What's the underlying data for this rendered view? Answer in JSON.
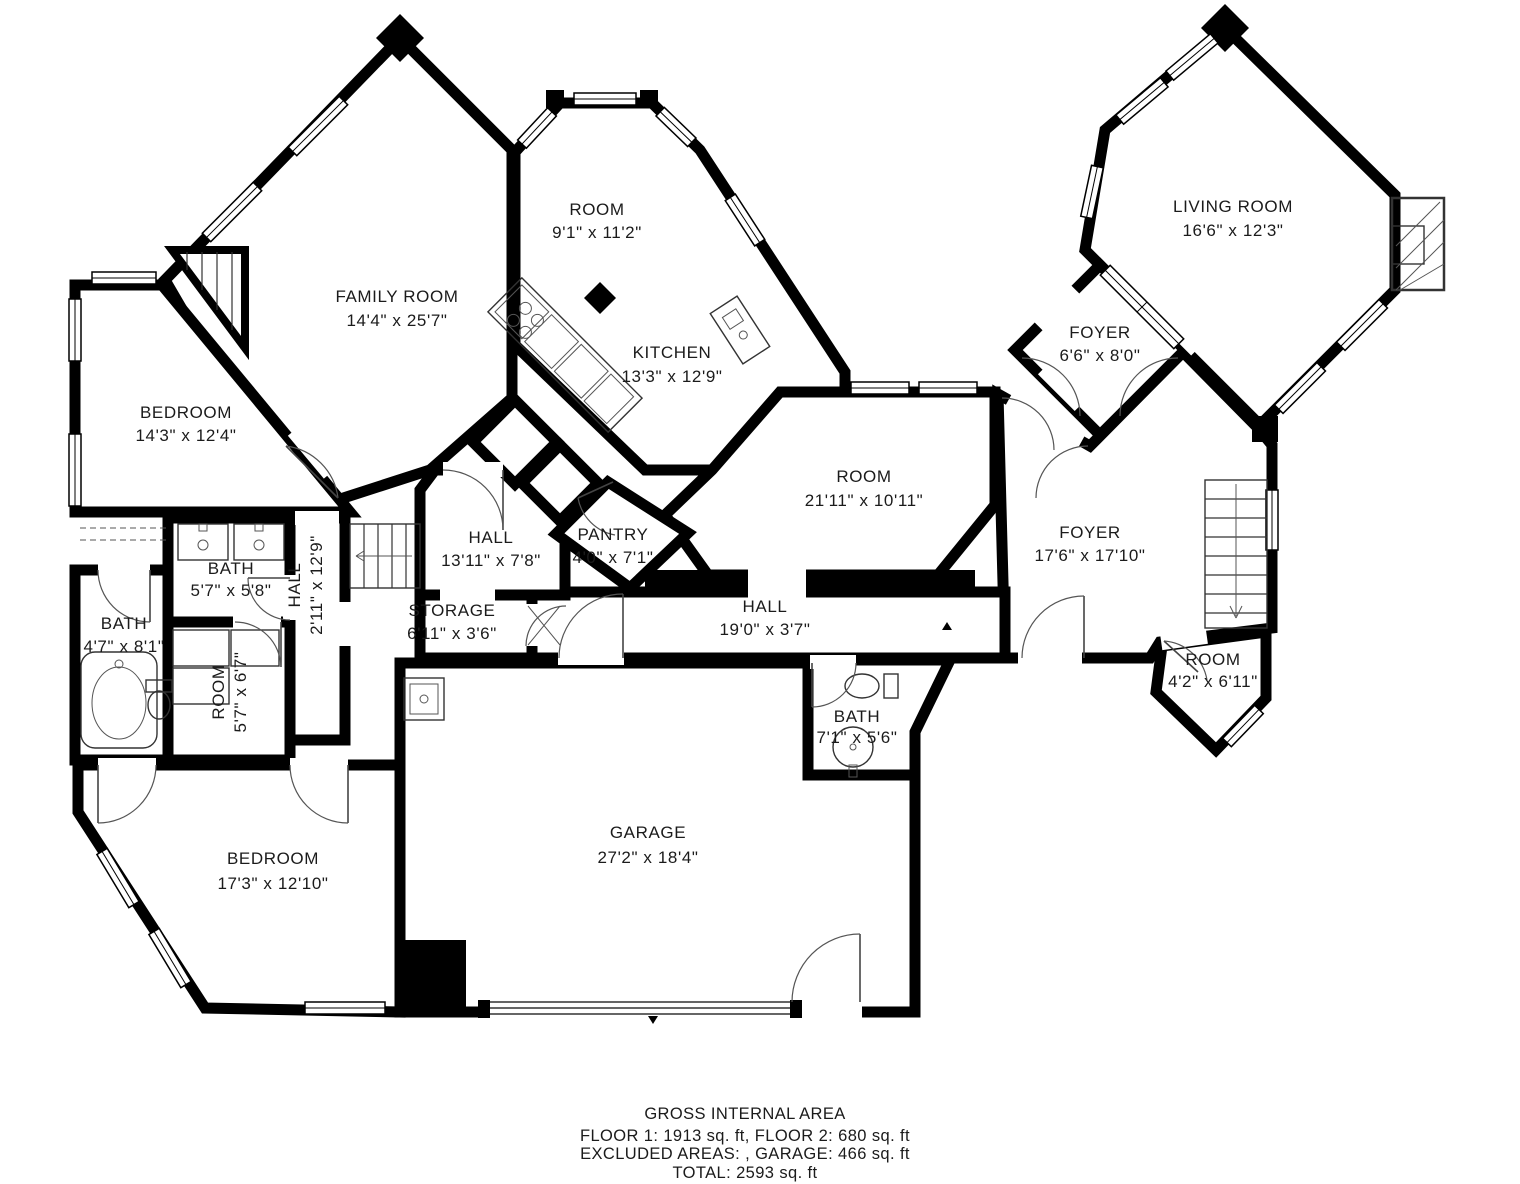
{
  "rooms": [
    {
      "id": "room-bay",
      "name": "ROOM",
      "dims": "9'1\" x 11'2\""
    },
    {
      "id": "family-room",
      "name": "FAMILY ROOM",
      "dims": "14'4\" x 25'7\""
    },
    {
      "id": "living-room",
      "name": "LIVING ROOM",
      "dims": "16'6\" x 12'3\""
    },
    {
      "id": "kitchen",
      "name": "KITCHEN",
      "dims": "13'3\" x 12'9\""
    },
    {
      "id": "foyer-small",
      "name": "FOYER",
      "dims": "6'6\" x 8'0\""
    },
    {
      "id": "bedroom-left",
      "name": "BEDROOM",
      "dims": "14'3\" x 12'4\""
    },
    {
      "id": "room-center",
      "name": "ROOM",
      "dims": "21'11\" x 10'11\""
    },
    {
      "id": "foyer-main",
      "name": "FOYER",
      "dims": "17'6\" x 17'10\""
    },
    {
      "id": "bath-upper",
      "name": "BATH",
      "dims": "5'7\" x 5'8\""
    },
    {
      "id": "hall-diagonal",
      "name": "HALL",
      "dims": "13'11\" x 7'8\""
    },
    {
      "id": "pantry",
      "name": "PANTRY",
      "dims": "4'0\" x 7'1\""
    },
    {
      "id": "hall-vertical",
      "name": "HALL",
      "dims": "2'11\" x 12'9\""
    },
    {
      "id": "bath-left",
      "name": "BATH",
      "dims": "4'7\" x 8'1\""
    },
    {
      "id": "room-small",
      "name": "ROOM",
      "dims": "5'7\" x 6'7\""
    },
    {
      "id": "storage",
      "name": "STORAGE",
      "dims": "6'11\" x 3'6\""
    },
    {
      "id": "hall-long",
      "name": "HALL",
      "dims": "19'0\" x 3'7\""
    },
    {
      "id": "room-right",
      "name": "ROOM",
      "dims": "4'2\" x 6'11\""
    },
    {
      "id": "bath-garage",
      "name": "BATH",
      "dims": "7'1\" x 5'6\""
    },
    {
      "id": "garage",
      "name": "GARAGE",
      "dims": "27'2\" x 18'4\""
    },
    {
      "id": "bedroom-bottom",
      "name": "BEDROOM",
      "dims": "17'3\" x 12'10\""
    }
  ],
  "footer": {
    "line1": "GROSS INTERNAL AREA",
    "line2": "FLOOR 1: 1913 sq. ft, FLOOR 2: 680 sq. ft",
    "line3": "EXCLUDED AREAS: , GARAGE: 466 sq. ft",
    "line4": "TOTAL: 2593 sq. ft"
  },
  "colors": {
    "wall": "#000000",
    "background": "#ffffff",
    "text": "#1b1b1b"
  }
}
